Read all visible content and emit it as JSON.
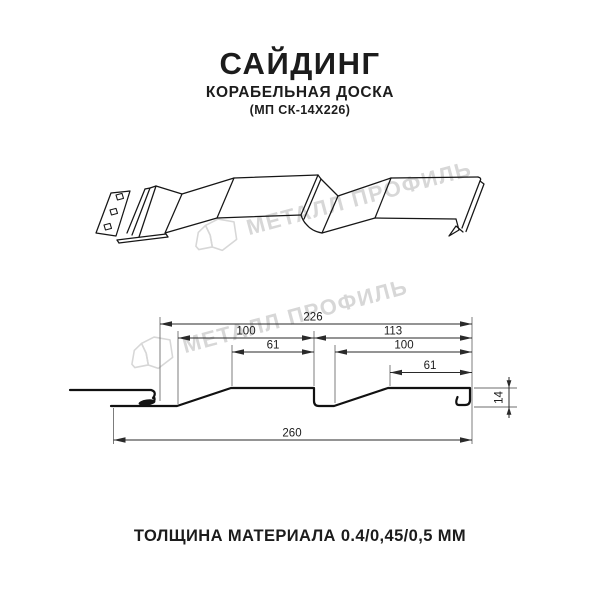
{
  "header": {
    "title": "САЙДИНГ",
    "subtitle": "КОРАБЕЛЬНАЯ ДОСКА",
    "model": "(МП СК-14Х226)"
  },
  "watermark": {
    "text": "МЕТАЛЛ ПРОФИЛЬ",
    "color": "#d7d7d7"
  },
  "diagram": {
    "type": "siding-profile-technical-drawing",
    "views": [
      "3d-perspective-view",
      "cross-section-with-dimensions"
    ],
    "units": "mm",
    "dimensions": {
      "working_width": "226",
      "left_module": "100",
      "right_module": "113",
      "left_flat": "61",
      "right_inner": "100",
      "right_flat": "61",
      "overall_width": "260",
      "profile_height": "14"
    }
  },
  "footer": {
    "thickness_note": "ТОЛЩИНА МАТЕРИАЛА 0.4/0,45/0,5 ММ"
  },
  "colors": {
    "line": "#161616",
    "dimension": "#2a2a2a",
    "extension": "#6e6e6e",
    "watermark": "#d7d7d7",
    "background": "#ffffff"
  }
}
